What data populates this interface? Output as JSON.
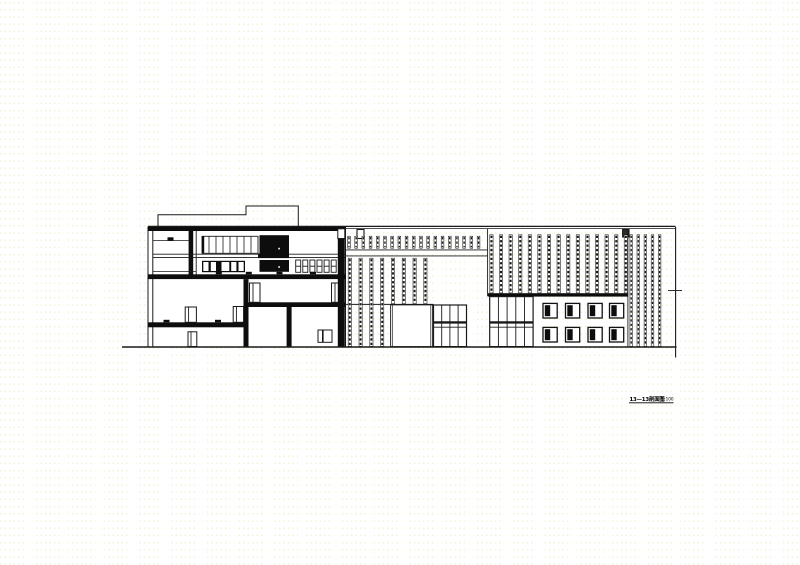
{
  "page": {
    "background_color": "#ffffff",
    "line_color": "#1a1a1a",
    "fill_color": "#0d0d0d",
    "watermark_color": "#d8d884"
  },
  "drawing": {
    "title": "13—13剖面图",
    "scale": "1:100"
  }
}
